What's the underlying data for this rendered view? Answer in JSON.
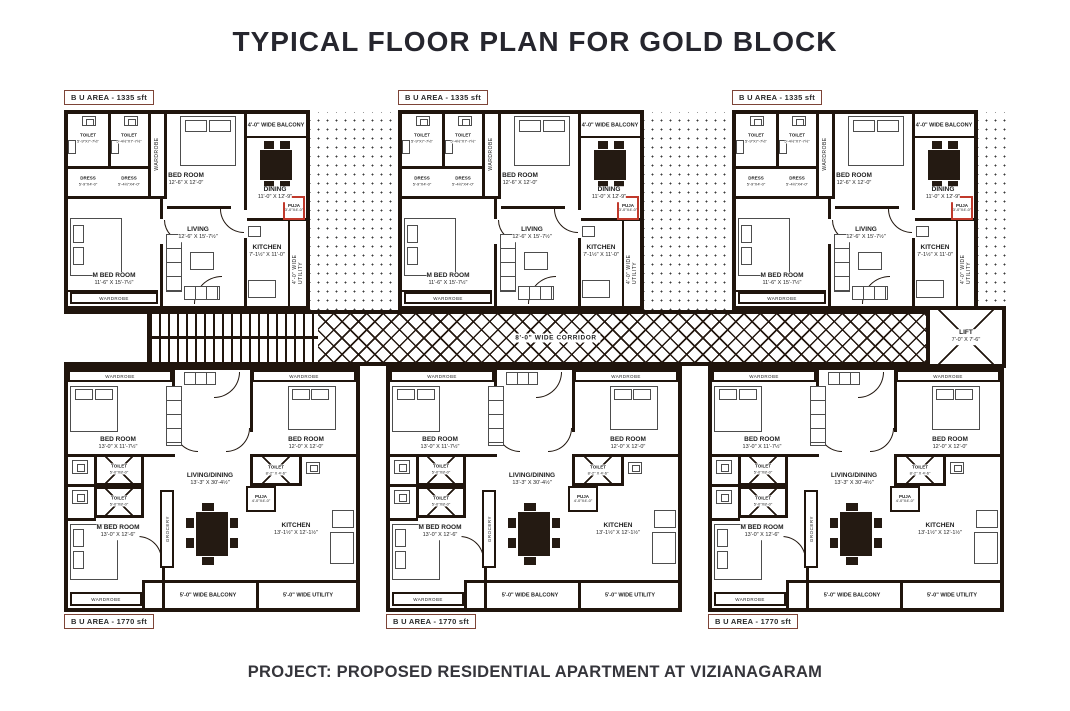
{
  "title": "TYPICAL FLOOR PLAN FOR GOLD BLOCK",
  "footer": "PROJECT: PROPOSED RESIDENTIAL APARTMENT AT VIZIANAGARAM",
  "colors": {
    "wall": "#20150d",
    "accent_red": "#c0392b",
    "title_text": "#26262e",
    "area_label_border": "#7d4437"
  },
  "top_unit": {
    "area_label": "B U  AREA - 1335 sft",
    "toilet1": {
      "name": "TOILET",
      "dim": "5'-9\"X7'-7½\""
    },
    "toilet2": {
      "name": "TOILET",
      "dim": "5'-4½\"X7'-7½\""
    },
    "dress1": {
      "name": "DRESS",
      "dim": "5'-9\"X4'-0\""
    },
    "dress2": {
      "name": "DRESS",
      "dim": "5'-4½\"X4'-0\""
    },
    "wardrobe_side": "WARDROBE",
    "bedroom": {
      "name": "BED ROOM",
      "dim": "12'-6\" X 12'-0\""
    },
    "balcony": "4'-0\" WIDE BALCONY",
    "dining": {
      "name": "DINING",
      "dim": "11'-0\" X 12'-9\""
    },
    "puja": {
      "name": "PUJA",
      "dim": "3'-0\"X4'-0\""
    },
    "living": {
      "name": "LIVING",
      "dim": "12'-6\" X 15'-7½\""
    },
    "kitchen": {
      "name": "KITCHEN",
      "dim": "7'-1½\" X 11'-0\""
    },
    "utility": "4'-0\" WIDE UTILITY",
    "m_bedroom": {
      "name": "M BED ROOM",
      "dim": "11'-6\" X 15'-7½\""
    },
    "wardrobe_bottom": "WARDROBE"
  },
  "bottom_unit": {
    "area_label": "B U  AREA - 1770 sft",
    "wardrobe_top_left": "WARDROBE",
    "wardrobe_top_right": "WARDROBE",
    "bedroom_left": {
      "name": "BED ROOM",
      "dim": "13'-0\" X 11'-7½\""
    },
    "bedroom_right": {
      "name": "BED ROOM",
      "dim": "12'-0\" X 12'-0\""
    },
    "toilet_top": {
      "name": "TOILET",
      "dim": "5'-0\"X8'-0\""
    },
    "toilet_bottom": {
      "name": "TOILET",
      "dim": "5'-0\"X8'-0\""
    },
    "toilet_right": {
      "name": "TOILET",
      "dim": "8'-2\" X 4'-6\""
    },
    "m_bedroom": {
      "name": "M BED ROOM",
      "dim": "13'-0\" X 12'-6\""
    },
    "living_dining": {
      "name": "LIVING/DINING",
      "dim": "13'-3\" X 30'-4½\""
    },
    "grocery": "GROCERY",
    "puja": {
      "name": "PUJA",
      "dim": "4'-0\"X4'-0\""
    },
    "kitchen": {
      "name": "KITCHEN",
      "dim": "13'-1½\" X 12'-1½\""
    },
    "balcony": "5'-0\" WIDE BALCONY",
    "utility": "5'-0\" WIDE UTILITY",
    "wardrobe_bottom": "WARDROBE"
  },
  "corridor": {
    "label": "8'-0\" WIDE CORRIDOR",
    "lift": {
      "name": "LIFT",
      "dim": "7'-0\" X 7'-6\""
    }
  }
}
